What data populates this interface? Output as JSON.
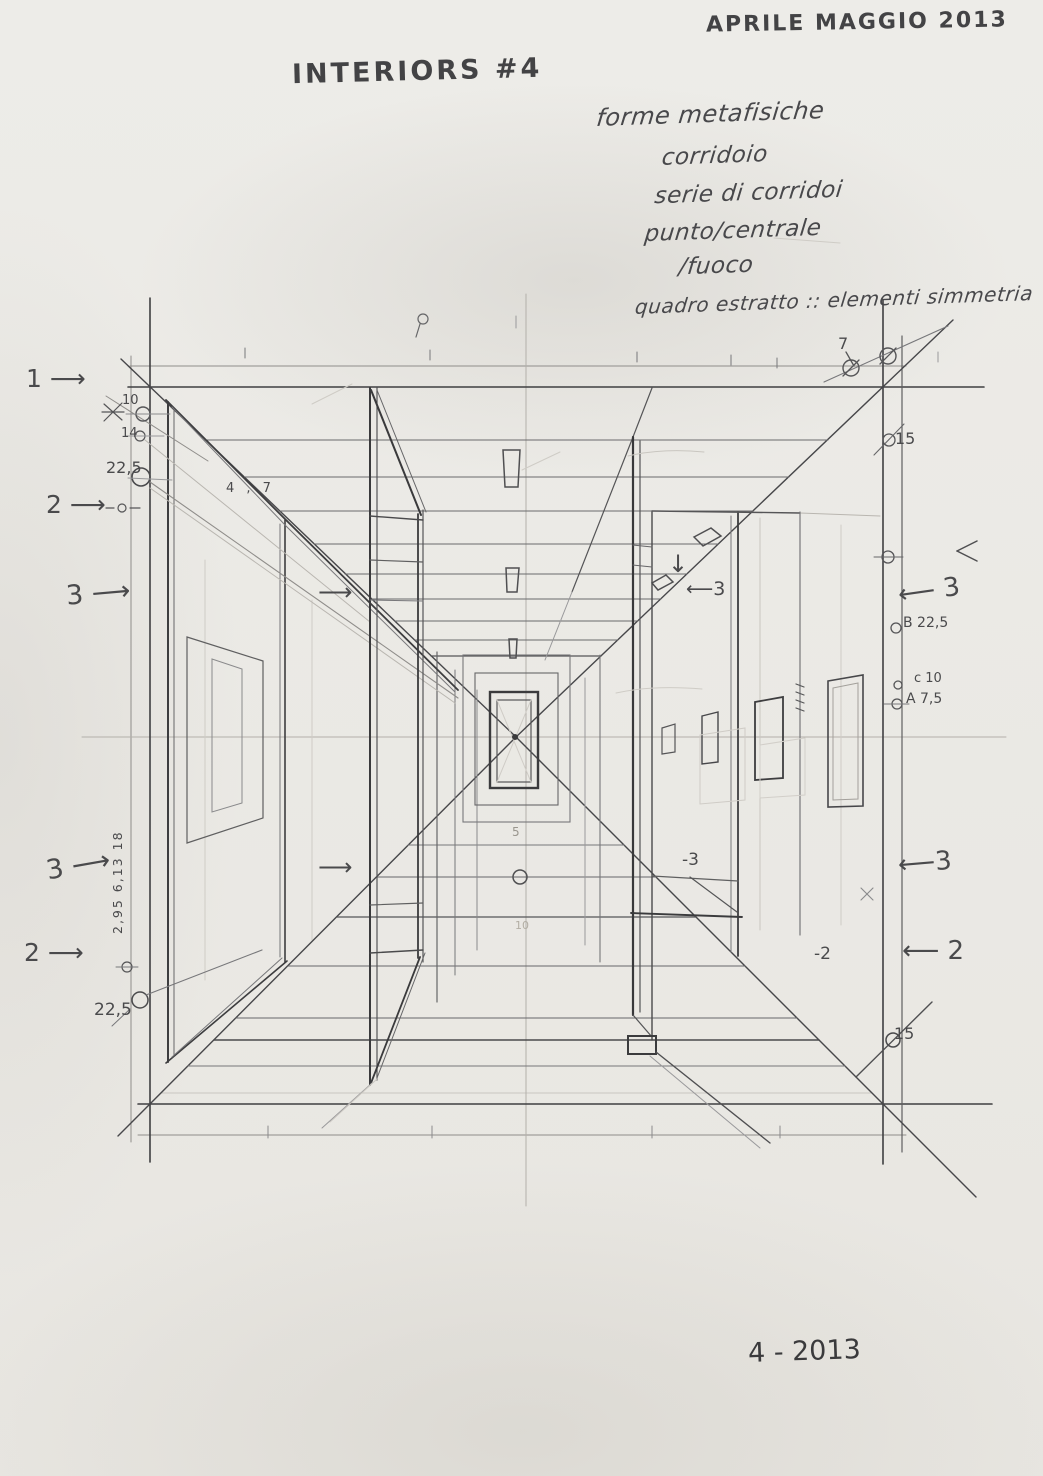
{
  "header": {
    "date_note": "APRILE MAGGIO 2013",
    "title": "INTERIORS #4"
  },
  "concept_notes": {
    "lines": [
      "forme metafisiche",
      "corridoio",
      "serie di corridoi",
      "punto/centrale",
      "/fuoco",
      "quadro estratto :: elementi simmetria"
    ]
  },
  "margin_left": {
    "section1": "1 ⟶",
    "dim_10": "10",
    "dim_14": "14",
    "dim_22_5_top": "22,5",
    "section2": "2 ⟶",
    "section3": "3 ⟶",
    "section3_lower": "3 ⟶",
    "vertical_dims": "2,95   6,13   18",
    "section2_lower": "2 ⟶",
    "dim_22_5_bottom": "22,5"
  },
  "margin_right": {
    "dim_7": "7",
    "dim_15_top": "15",
    "section3": "⟵ 3",
    "point_b": "B 22,5",
    "point_c": "c 10",
    "point_a": "A 7,5",
    "section3_lower": "⟵3",
    "section2_lower": "⟵ 2",
    "dim_15_bottom": "15"
  },
  "drawing_labels": {
    "dim_4_7": "4 , 7",
    "arrow_wall_upper": "⟶",
    "arrow_wall_lower": "⟶",
    "arrow_down": "↓",
    "arrow_3_inner": "⟵3",
    "label_3_inner": "-3",
    "label_2_inner": "-2",
    "depth_5": "5",
    "depth_10": "10"
  },
  "footer": {
    "date": "4 - 2013"
  }
}
